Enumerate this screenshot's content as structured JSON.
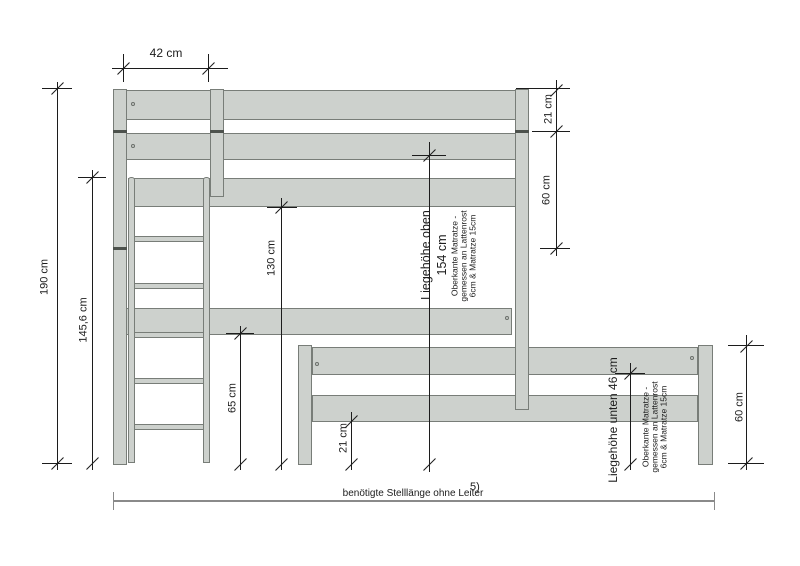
{
  "meta": {
    "figure_ref": "5)"
  },
  "labels": {
    "top_width": "42 cm",
    "left_total_height": "190 cm",
    "left_height": "145,6 cm",
    "under_top_bed_clearance": "130 cm",
    "under_long_rail_clearance": "65 cm",
    "lower_frame_clearance": "21 cm",
    "right_guardrail_gap": "21 cm",
    "right_guardrail_height": "60 cm",
    "right_lower_bed_height": "60 cm",
    "top_lying_height": "Liegehöhe oben",
    "top_lying_height_value": "154 cm",
    "bottom_lying_height": "Liegehöhe unten 46 cm",
    "mattress_note": {
      "line1": "Oberkante Matratze -",
      "line2": "gemessen an Lattenrost",
      "line3": "6cm & Matratze 15cm"
    },
    "bottom_note": "benötigte Stelllänge ohne Leiter"
  },
  "colors": {
    "wood_fill": "#cdd1cd",
    "wood_border": "#787d78",
    "dim_line": "#1c1c1c",
    "baseline": "#8a8a8a"
  }
}
